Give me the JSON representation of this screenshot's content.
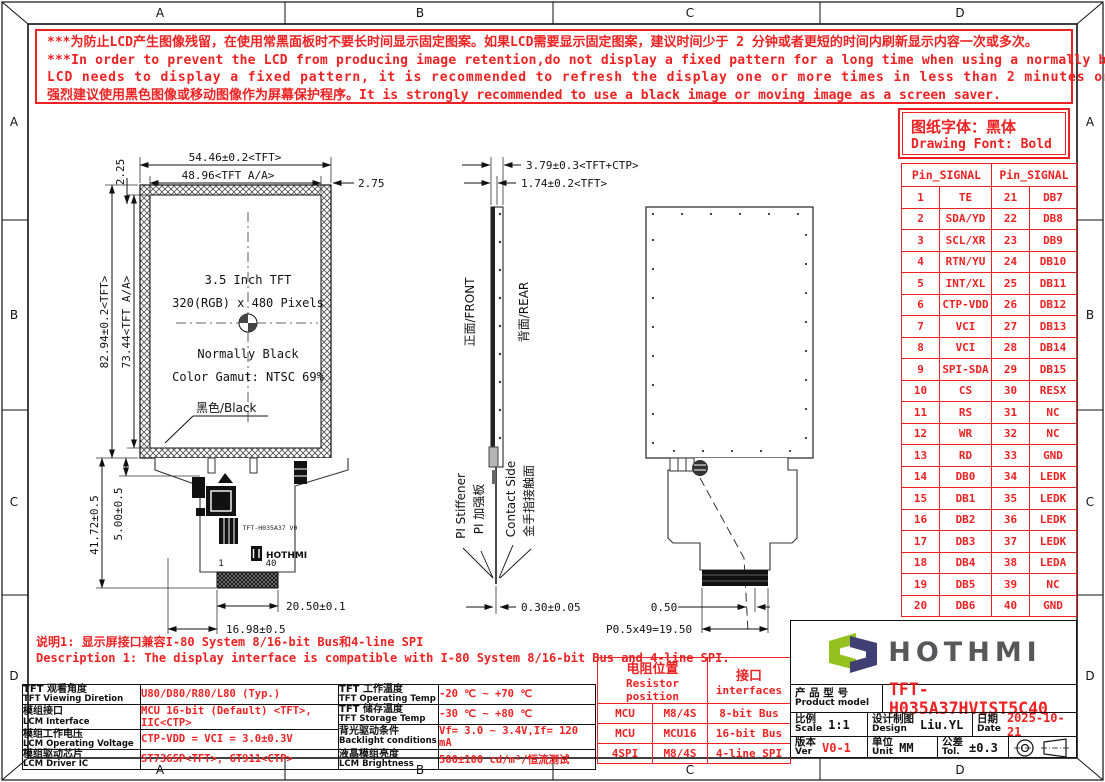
{
  "sheet": {
    "zone_labels": [
      "A",
      "B",
      "C",
      "D"
    ]
  },
  "warning": {
    "lines": [
      "***为防止LCD产生图像残留，在使用常黑面板时不要长时间显示固定图案。如果LCD需要显示固定图案，建议时间少于 2 分钟或者更短的时间内刷新显示内容一次或多次。",
      "***In order to prevent the LCD from producing image retention,do not display a fixed pattern for a long time when using a normally black panel.If the",
      "LCD needs to display a fixed pattern, it is recommended to refresh the display one or more times in less than 2 minutes or less.",
      "强烈建议使用黑色图像或移动图像作为屏幕保护程序。It is strongly recommended to use a black image or moving image as a screen saver."
    ]
  },
  "font_note": {
    "cn": "图纸字体：黑体",
    "en": "Drawing Font: Bold"
  },
  "pin_table": {
    "headers": [
      "Pin_SIGNAL",
      "Pin_SIGNAL"
    ],
    "rows": [
      {
        "p1": "1",
        "s1": "TE",
        "p2": "21",
        "s2": "DB7"
      },
      {
        "p1": "2",
        "s1": "SDA/YD",
        "p2": "22",
        "s2": "DB8"
      },
      {
        "p1": "3",
        "s1": "SCL/XR",
        "p2": "23",
        "s2": "DB9"
      },
      {
        "p1": "4",
        "s1": "RTN/YU",
        "p2": "24",
        "s2": "DB10"
      },
      {
        "p1": "5",
        "s1": "INT/XL",
        "p2": "25",
        "s2": "DB11"
      },
      {
        "p1": "6",
        "s1": "CTP-VDD",
        "p2": "26",
        "s2": "DB12"
      },
      {
        "p1": "7",
        "s1": "VCI",
        "p2": "27",
        "s2": "DB13"
      },
      {
        "p1": "8",
        "s1": "VCI",
        "p2": "28",
        "s2": "DB14"
      },
      {
        "p1": "9",
        "s1": "SPI-SDA",
        "p2": "29",
        "s2": "DB15"
      },
      {
        "p1": "10",
        "s1": "CS",
        "p2": "30",
        "s2": "RESX"
      },
      {
        "p1": "11",
        "s1": "RS",
        "p2": "31",
        "s2": "NC"
      },
      {
        "p1": "12",
        "s1": "WR",
        "p2": "32",
        "s2": "NC"
      },
      {
        "p1": "13",
        "s1": "RD",
        "p2": "33",
        "s2": "GND"
      },
      {
        "p1": "14",
        "s1": "DB0",
        "p2": "34",
        "s2": "LEDK"
      },
      {
        "p1": "15",
        "s1": "DB1",
        "p2": "35",
        "s2": "LEDK"
      },
      {
        "p1": "16",
        "s1": "DB2",
        "p2": "36",
        "s2": "LEDK"
      },
      {
        "p1": "17",
        "s1": "DB3",
        "p2": "37",
        "s2": "LEDK"
      },
      {
        "p1": "18",
        "s1": "DB4",
        "p2": "38",
        "s2": "LEDA"
      },
      {
        "p1": "19",
        "s1": "DB5",
        "p2": "39",
        "s2": "NC"
      },
      {
        "p1": "20",
        "s1": "DB6",
        "p2": "40",
        "s2": "GND"
      }
    ]
  },
  "front_view": {
    "dim_width_tft": "54.46±0.2<TFT>",
    "dim_width_aa": "48.96<TFT A/A>",
    "dim_right_margin": "2.75",
    "dim_top_margin": "2.25",
    "dim_height_tft": "82.94±0.2<TFT>",
    "dim_height_aa": "73.44<TFT A/A>",
    "dim_fpc_length": "41.72±0.5",
    "dim_panel_to_fpc": "5.00±0.5",
    "dim_connector_width": "20.50±0.1",
    "dim_tail_offset": "16.98±0.5",
    "panel_line1": "3.5 Inch TFT",
    "panel_line2": "320(RGB) x 480 Pixels",
    "panel_line3": "Normally Black",
    "panel_line4": "Color Gamut: NTSC 69%",
    "black_label": "黑色/Black",
    "fpc_marking": "TFT-H035A37 V0",
    "fpc_logo": "HOTHMI",
    "pin_first": "1",
    "pin_last": "40"
  },
  "side_view": {
    "dim_total_thickness": "3.79±0.3<TFT+CTP>",
    "dim_tft_thickness": "1.74±0.2<TFT>",
    "front_label": "正面/FRONT",
    "rear_label": "背面/REAR",
    "stiffener_en": "PI Stiffener",
    "stiffener_cn": "PI 加强板",
    "contact_en": "Contact Side",
    "contact_cn": "金手指接触面",
    "dim_fpc_thickness": "0.30±0.05"
  },
  "rear_view": {
    "dim_pitch_offset": "0.50",
    "dim_pitch_total": "P0.5x49=19.50"
  },
  "note": {
    "line_cn": "说明1: 显示屏接口兼容I-80 System 8/16-bit Bus和4-line SPI",
    "line_en": "Description 1: The display interface is compatible with I-80 System 8/16-bit Bus and 4-line SPI."
  },
  "spec_left": {
    "rows": [
      {
        "cn": "TFT 观看角度",
        "en": "TFT Viewing Diretion",
        "value": "U80/D80/R80/L80 (Typ.)"
      },
      {
        "cn": "模组接口",
        "en": "LCM Interface",
        "value": "MCU 16-bit (Default) <TFT>, IIC<CTP>"
      },
      {
        "cn": "模组工作电压",
        "en": "LCM Operating Voltage",
        "value": "CTP-VDD = VCI = 3.0±0.3V"
      },
      {
        "cn": "模组驱动芯片",
        "en": "LCM Driver IC",
        "value": "ST7365P<TFT>, GT911<CTP>"
      }
    ]
  },
  "spec_mid": {
    "rows": [
      {
        "cn": "TFT 工作温度",
        "en": "TFT Operating Temp",
        "value": "-20 ℃ ~ +70 ℃"
      },
      {
        "cn": "TFT 储存温度",
        "en": "TFT Storage Temp",
        "value": "-30 ℃ ~ +80 ℃"
      },
      {
        "cn": "背光驱动条件",
        "en": "Backlight conditions",
        "value": "Vf= 3.0 ~ 3.4V,If= 120 mA"
      },
      {
        "cn": "液晶模组亮度",
        "en": "LCM Brightness",
        "value": "500±100  cd/m²/恒流测试"
      }
    ]
  },
  "resistor_table": {
    "header_pos_cn": "电阻位置",
    "header_pos_en": "Resistor position",
    "header_if_cn": "接口",
    "header_if_en": "interfaces",
    "rows": [
      {
        "c1": "MCU",
        "c2": "M8/4S",
        "c3": "8-bit Bus"
      },
      {
        "c1": "MCU",
        "c2": "MCU16",
        "c3": "16-bit Bus"
      },
      {
        "c1": "4SPI",
        "c2": "M8/4S",
        "c3": "4-line SPI"
      }
    ]
  },
  "title_block": {
    "logo_text": "HOTHMI",
    "model_cn": "产 品 型 号",
    "model_en": "Product model",
    "model_value": "TFT-H035A37HVIST5C40",
    "scale_cn": "比例",
    "scale_en": "Scale",
    "scale_value": "1:1",
    "design_cn": "设计制图",
    "design_en": "Design",
    "design_value": "Liu.YL",
    "date_cn": "日期",
    "date_en": "Date",
    "date_value": "2025-10-21",
    "ver_cn": "版本",
    "ver_en": "Ver",
    "ver_value": "V0-1",
    "unit_cn": "单位",
    "unit_en": "Unit",
    "unit_value": "MM",
    "tol_cn": "公差",
    "tol_en": "Tol.",
    "tol_value": "±0.3"
  }
}
